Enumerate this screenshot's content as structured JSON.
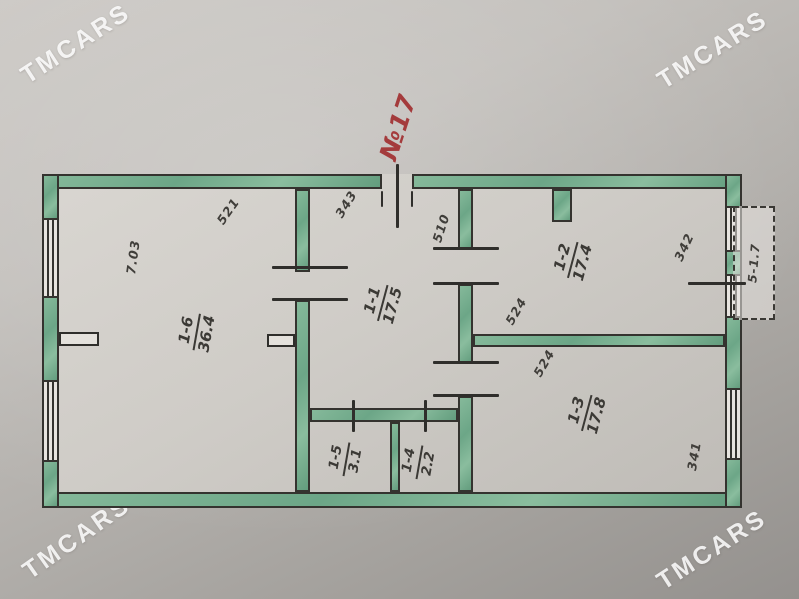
{
  "photo": {
    "watermark": "TMCARS",
    "plan_number": "№17"
  },
  "rooms": [
    {
      "id": "1-6",
      "area": "36.4"
    },
    {
      "id": "1-1",
      "area": "17.5"
    },
    {
      "id": "1-2",
      "area": "17.4"
    },
    {
      "id": "1-3",
      "area": "17.8"
    },
    {
      "id": "1-5",
      "area": "3.1"
    },
    {
      "id": "1-4",
      "area": "2.2"
    }
  ],
  "balcony": {
    "label": "5-1.7"
  },
  "dimensions": [
    {
      "name": "room-1-6-depth",
      "value": "7.03"
    },
    {
      "name": "room-1-6-width",
      "value": "521"
    },
    {
      "name": "room-1-1-width",
      "value": "343"
    },
    {
      "name": "room-1-1-depth",
      "value": "510"
    },
    {
      "name": "room-1-2-width",
      "value": "342"
    },
    {
      "name": "room-1-2-depth",
      "value": "524"
    },
    {
      "name": "room-1-3-depth",
      "value": "524"
    },
    {
      "name": "room-1-3-width",
      "value": "341"
    }
  ],
  "colors": {
    "wall_green": "#6ca687",
    "line_black": "#2f2e2b",
    "pencil_text": "#3b3935",
    "annotation_red": "#a43b3c",
    "paper": "#c2bfbb"
  }
}
